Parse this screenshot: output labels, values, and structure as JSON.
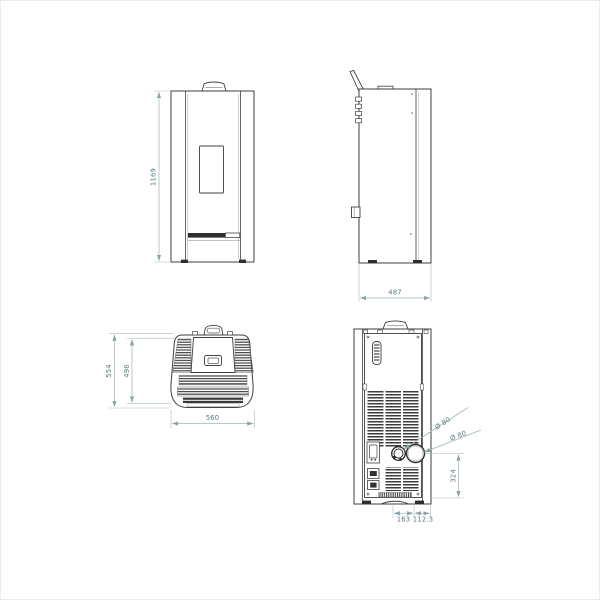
{
  "drawing": {
    "type": "technical-orthographic-views",
    "subject": "pellet stove dimensional diagram",
    "line_color": "#3f3f3f",
    "dimension_line_color": "#9fb5b8",
    "dimension_text_color": "#5a7c80",
    "background_color": "#ffffff",
    "views": {
      "front": {
        "name": "front view",
        "height_label": "1169"
      },
      "side": {
        "name": "side view",
        "depth_label": "487"
      },
      "top": {
        "name": "top view",
        "depth_outer_label": "554",
        "depth_inner_label": "496",
        "width_label": "560"
      },
      "back": {
        "name": "back view",
        "flue_upper_label": "Ø 80",
        "flue_lower_label": "Ø 80",
        "outlet_height_label": "324",
        "offset_left_label": "163",
        "offset_right_label": "112.3"
      }
    }
  }
}
